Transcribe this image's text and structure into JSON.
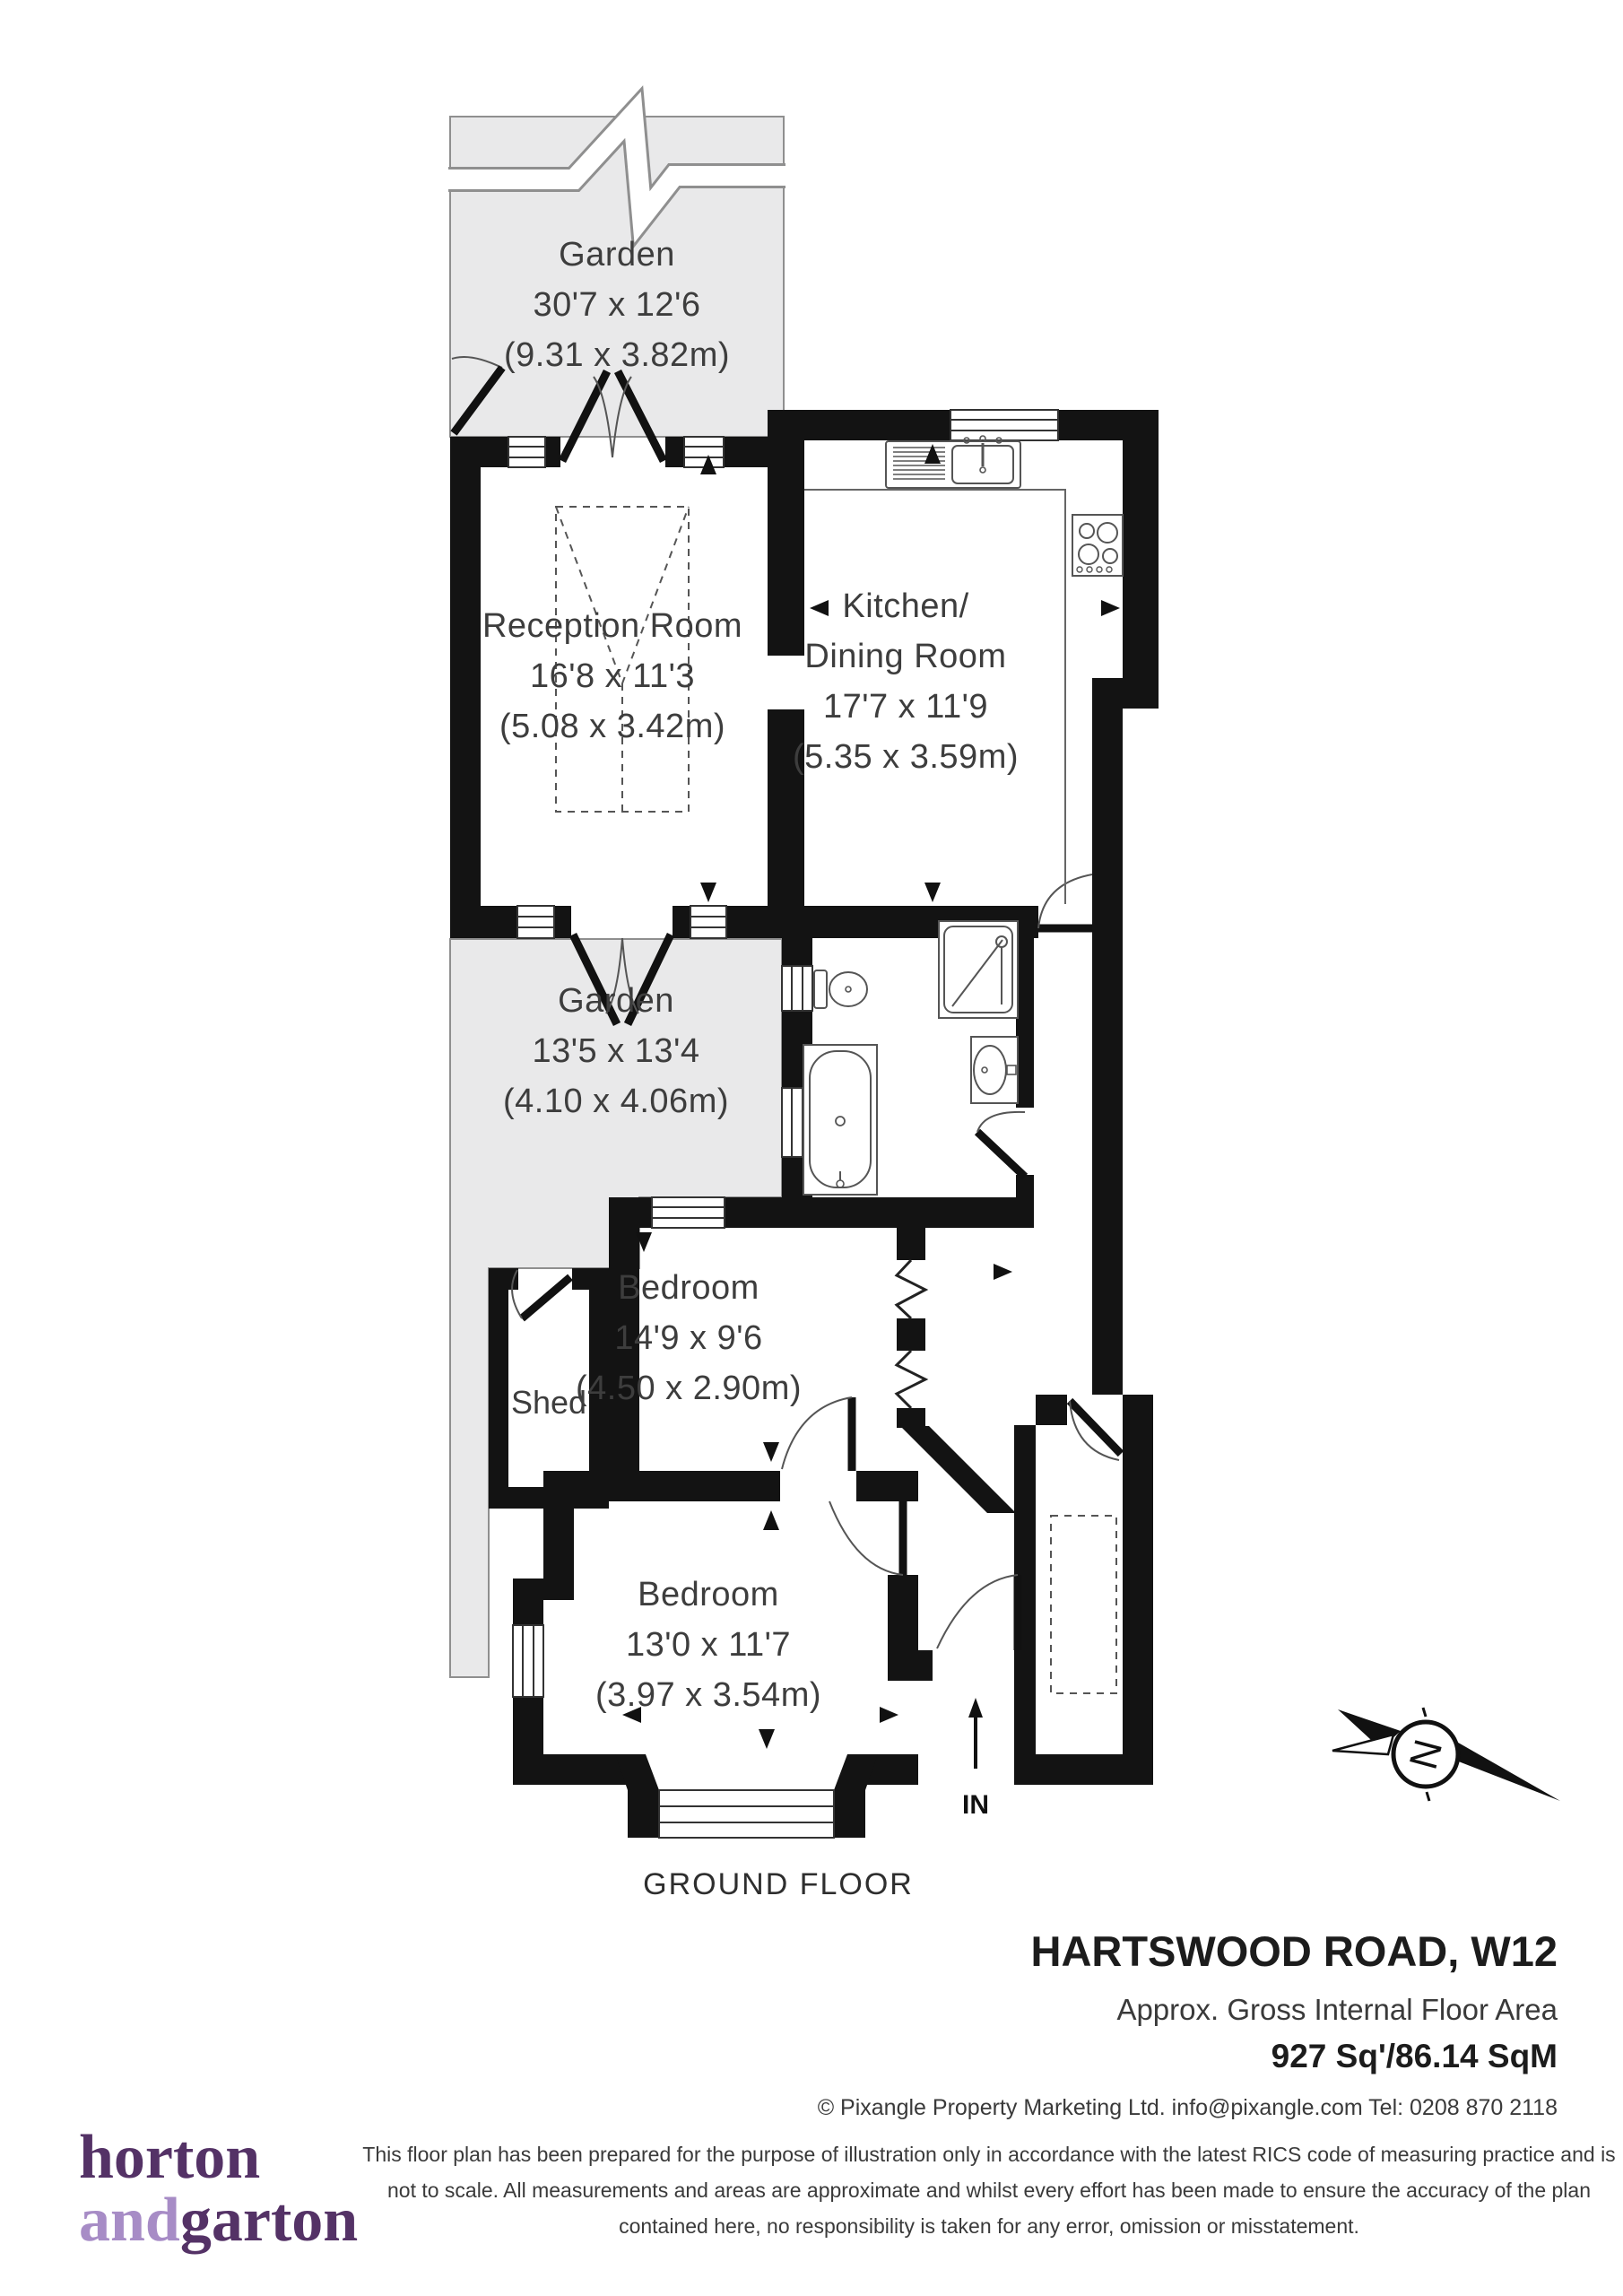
{
  "plan": {
    "floor_label": "GROUND FLOOR",
    "entrance_label": "IN",
    "compass_label": "N",
    "rooms": {
      "garden_top": {
        "name": "Garden",
        "imperial": "30'7 x 12'6",
        "metric": "(9.31 x 3.82m)"
      },
      "reception": {
        "name": "Reception Room",
        "imperial": "16'8 x 11'3",
        "metric": "(5.08 x 3.42m)"
      },
      "kitchen": {
        "name_line1": "Kitchen/",
        "name_line2": "Dining Room",
        "imperial": "17'7 x 11'9",
        "metric": "(5.35 x 3.59m)"
      },
      "garden_middle": {
        "name": "Garden",
        "imperial": "13'5 x 13'4",
        "metric": "(4.10 x 4.06m)"
      },
      "shed": {
        "name": "Shed"
      },
      "bedroom_1": {
        "name": "Bedroom",
        "imperial": "14'9 x 9'6",
        "metric": "(4.50 x 2.90m)"
      },
      "bedroom_2": {
        "name": "Bedroom",
        "imperial": "13'0 x 11'7",
        "metric": "(3.97 x 3.54m)"
      }
    }
  },
  "footer": {
    "address": "HARTSWOOD ROAD, W12",
    "area_label": "Approx. Gross Internal Floor Area",
    "area_value": "927 Sq'/86.14 SqM",
    "copyright": "© Pixangle Property Marketing Ltd. info@pixangle.com Tel: 0208 870 2118",
    "disclaimer_line1": "This floor plan has been prepared for the purpose of illustration only in accordance with the latest RICS code of measuring practice and is",
    "disclaimer_line2": "not to scale. All measurements and areas are approximate and whilst every effort has been made to ensure the accuracy of the plan",
    "disclaimer_line3": "contained here, no responsibility is taken for any error, omission or misstatement."
  },
  "logo": {
    "word1": "horton",
    "word2": "and",
    "word3": "garton"
  },
  "colors": {
    "wall": "#131313",
    "garden_fill": "#e9e9ea",
    "garden_outline": "#8f8f8f",
    "logo_dark": "#543266",
    "logo_light": "#a78cc6",
    "text": "#3d3d3d"
  }
}
